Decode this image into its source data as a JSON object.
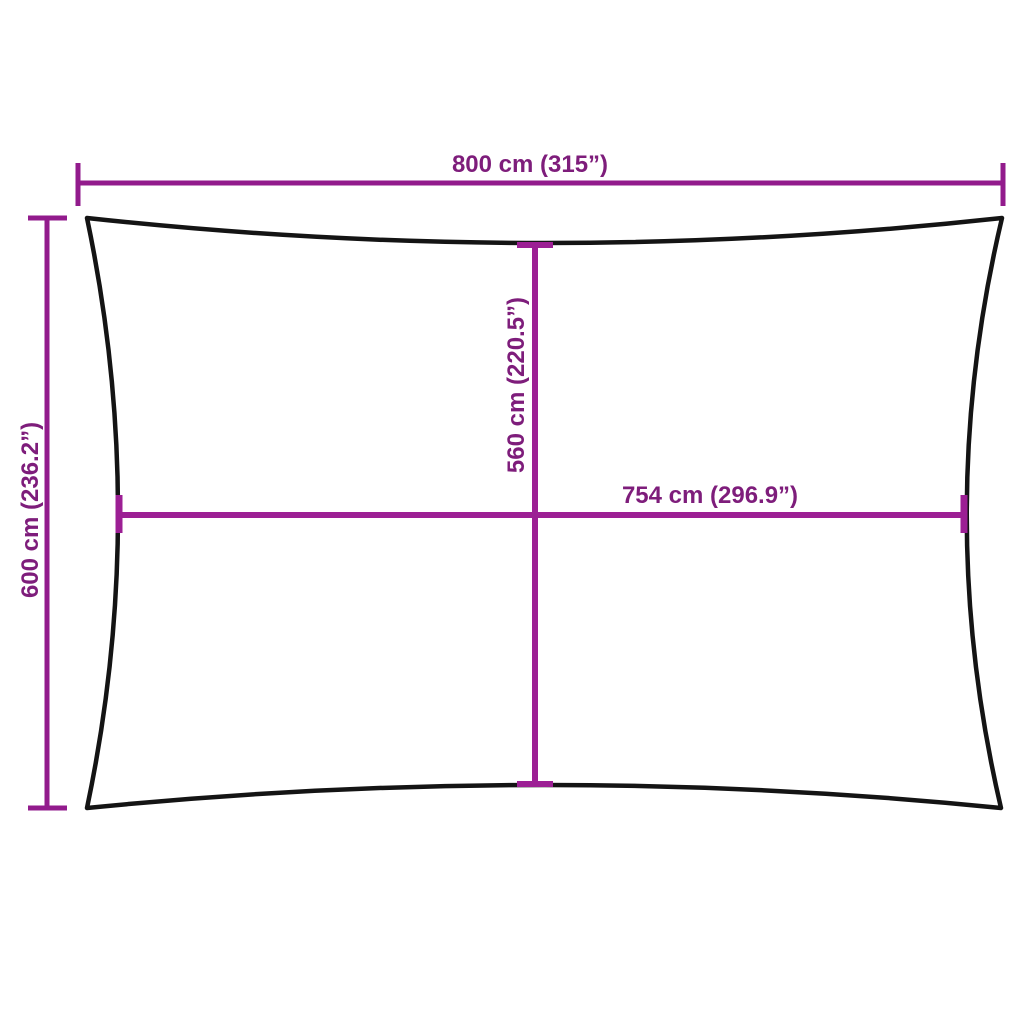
{
  "diagram": {
    "type": "product-dimension-diagram",
    "shape": "rectangle-concave-edges",
    "colors": {
      "background": "#ffffff",
      "outline": "#141414",
      "dimension_line": "#921b8c",
      "inner_dimension_line": "#9c1f94",
      "label_text": "#7e1d7b"
    },
    "measurements": {
      "top_width": {
        "cm": "800",
        "inches": "315",
        "label": "800 cm (315”)"
      },
      "left_height": {
        "cm": "600",
        "inches": "236.2",
        "label": "600 cm (236.2”)"
      },
      "inner_height": {
        "cm": "560",
        "inches": "220.5",
        "label": "560 cm (220.5”)"
      },
      "inner_width": {
        "cm": "754",
        "inches": "296.9",
        "label": "754 cm (296.9”)"
      }
    }
  }
}
